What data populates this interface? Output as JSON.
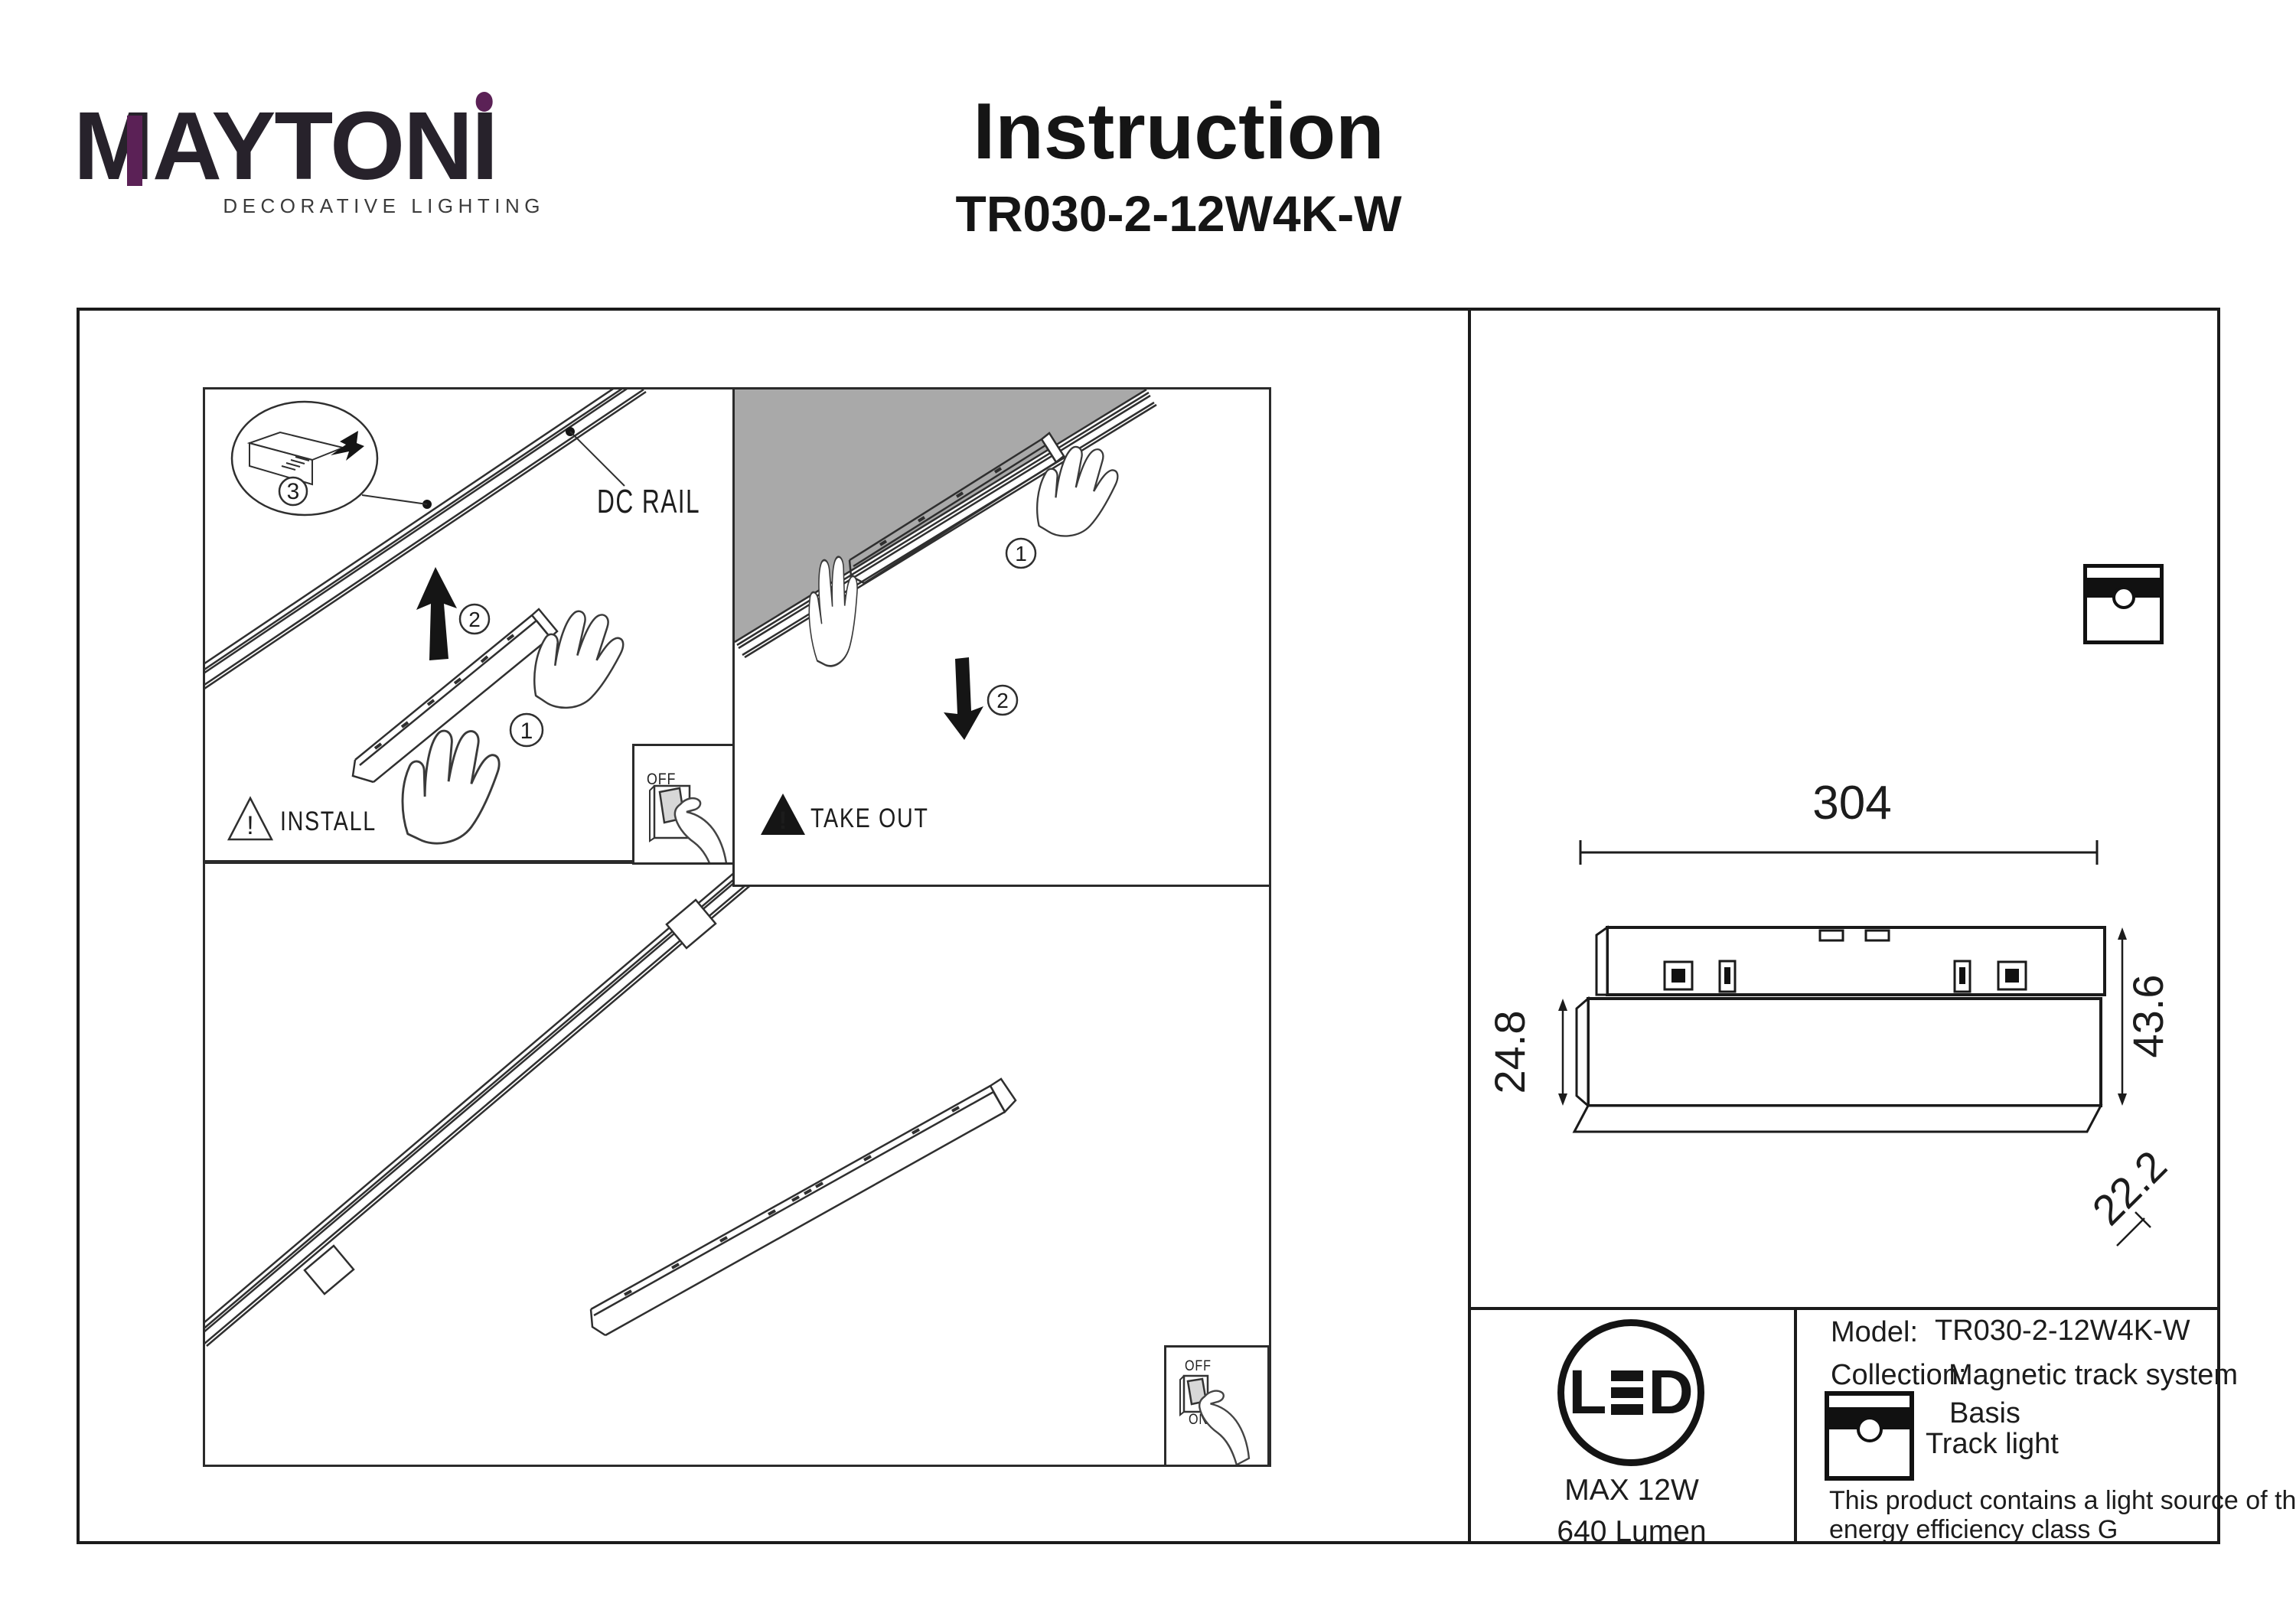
{
  "colors": {
    "accent_purple": "#5b2156",
    "ink": "#1c1c1c",
    "gray_ceiling": "#a9a9a9",
    "rocker_gray": "#d7d7d7"
  },
  "brand": {
    "logo_m": "M",
    "logo_mid": "AYTON",
    "logo_i": "I",
    "tagline": "DECORATIVE LIGHTING"
  },
  "header": {
    "title": "Instruction",
    "model": "TR030-2-12W4K-W"
  },
  "install": {
    "caption": "INSTALL",
    "warning_mark": "!",
    "rail_label": "DC RAIL",
    "step1": "1",
    "step2": "2",
    "step3": "3",
    "switch": {
      "off": "OFF",
      "on": "ON"
    }
  },
  "takeout": {
    "caption": "TAKE OUT",
    "warning_mark": "!",
    "step1": "1",
    "step2": "2"
  },
  "overview": {
    "switch": {
      "off": "OFF",
      "on": "ON"
    }
  },
  "dimensions": {
    "length": "304",
    "total_height": "43.6",
    "body_height": "24.8",
    "depth": "22.2"
  },
  "badge": {
    "led_l": "L",
    "led_d": "D",
    "max_power": "MAX 12W",
    "luminous_flux": "640 Lumen"
  },
  "spec_table": {
    "model_label": "Model:",
    "model_value": "TR030-2-12W4K-W",
    "collection_label": "Collection:",
    "collection_value": "Magnetic track system",
    "basis_label": "Basis",
    "track_light_label": "Track light",
    "energy_note_line1": "This product contains a light source of the",
    "energy_note_line2": "energy efficiency class G"
  }
}
